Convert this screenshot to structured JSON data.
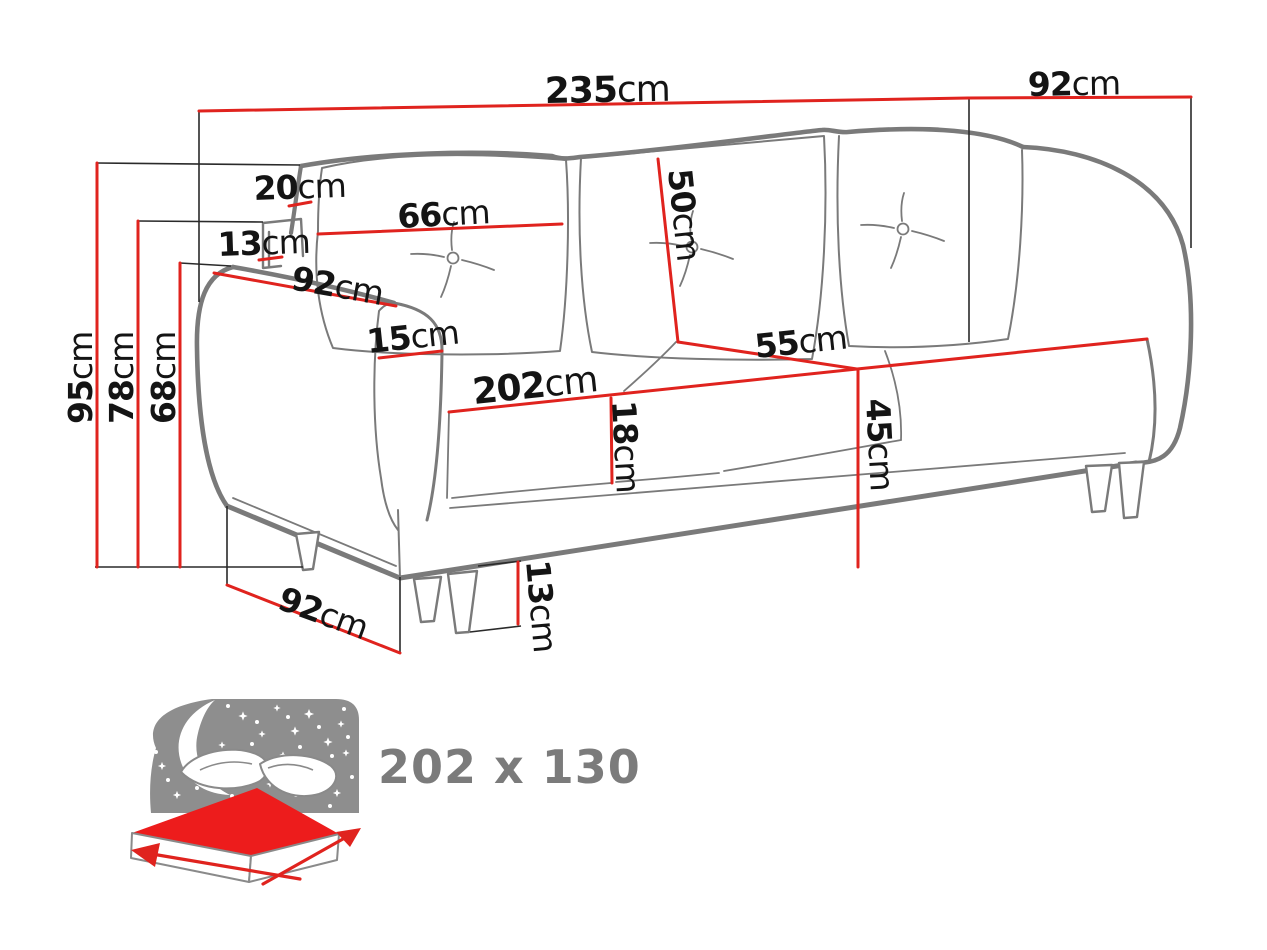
{
  "diagram": {
    "title_hint": "sofa-dimensions-drawing",
    "colors": {
      "dimension_red": "#e0231e",
      "outline_gray": "#7a7a7a",
      "label_black": "#141414",
      "icon_gray": "#8e8e8e",
      "sleeping_text_gray": "#7b7b7b",
      "mattress_red": "#ed1c1c"
    },
    "dimensions": {
      "total_width": {
        "value": "235",
        "unit": "cm"
      },
      "total_depth": {
        "value": "92",
        "unit": "cm"
      },
      "total_height": {
        "value": "95",
        "unit": "cm"
      },
      "armrest_shelf_height": {
        "value": "78",
        "unit": "cm"
      },
      "armrest_height": {
        "value": "68",
        "unit": "cm"
      },
      "backrest_top_width": {
        "value": "20",
        "unit": "cm"
      },
      "armrest_shelf_thickness": {
        "value": "13",
        "unit": "cm"
      },
      "back_cushion_width": {
        "value": "66",
        "unit": "cm"
      },
      "back_cushion_height": {
        "value": "50",
        "unit": "cm"
      },
      "armrest_length": {
        "value": "92",
        "unit": "cm"
      },
      "armrest_width": {
        "value": "15",
        "unit": "cm"
      },
      "seat_width": {
        "value": "202",
        "unit": "cm"
      },
      "seat_depth": {
        "value": "55",
        "unit": "cm"
      },
      "seat_cushion_thickness": {
        "value": "18",
        "unit": "cm"
      },
      "seat_height": {
        "value": "45",
        "unit": "cm"
      },
      "base_depth": {
        "value": "92",
        "unit": "cm"
      },
      "leg_height": {
        "value": "13",
        "unit": "cm"
      }
    },
    "sleeping_area": {
      "label": "202 x 130"
    }
  }
}
